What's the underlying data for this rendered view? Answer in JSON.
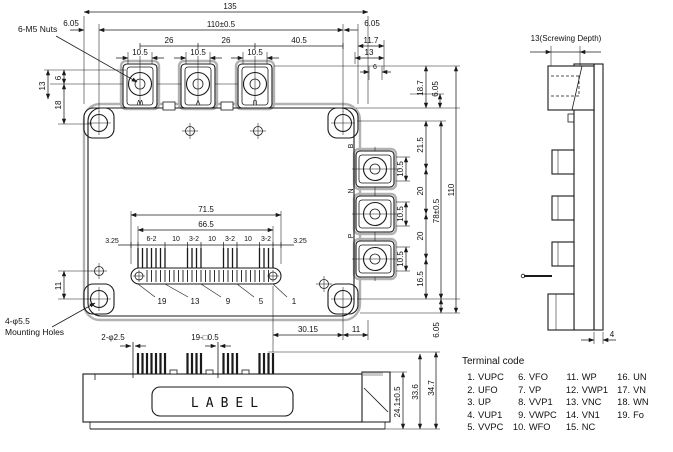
{
  "dims": {
    "overall_w": "135",
    "body_w": "110±0.5",
    "edge_l": "6.05",
    "edge_r": "6.05",
    "pitch_a": "26",
    "pitch_b": "26",
    "pitch_c": "40.5",
    "pad_a": "10.5",
    "pad_b": "10.5",
    "pad_c": "10.5",
    "r_top_a": "11.7",
    "r_top_b": "13",
    "r_top_c": "6",
    "l_a": "13",
    "l_b": "6",
    "l_c": "18",
    "l_d": "11",
    "rs_a": "18.7",
    "rs_b": "6.05",
    "rs_c": "21.5",
    "rs_d": "10.5",
    "rs_e": "20",
    "rs_f": "10.5",
    "rs_g": "20",
    "rs_h": "10.5",
    "rs_i": "16.5",
    "rs_pitch": "78±0.5",
    "rs_overall": "110",
    "rs_bottom": "6.05",
    "b_a": "30.15",
    "b_b": "11",
    "pins_outer": "71.5",
    "pins_inner": "66.5",
    "pins_edge_l": "3.25",
    "pins_edge_r": "3.25",
    "pg1": "6-2",
    "ps1": "10",
    "pg2": "3-2",
    "ps2": "10",
    "pg3": "3-2",
    "ps3": "10",
    "pg4": "3-2",
    "pn1": "19",
    "pn2": "13",
    "pn3": "9",
    "pn4": "5",
    "pn5": "1",
    "fv_pin_round": "2-φ2.5",
    "fv_pin_sq": "19-□0.5",
    "fv_a": "24.1±0.5",
    "fv_b": "33.6",
    "fv_c": "34.7",
    "sv_screw": "13(Screwing Depth)",
    "sv_base": "4"
  },
  "labels": {
    "nuts": "6-M5 Nuts",
    "mount1": "4-φ5.5",
    "mount2": "Mounting Holes",
    "label_word": "LABEL",
    "t_w": "W",
    "t_v": "V",
    "t_u": "U",
    "t_b": "B",
    "t_n": "N",
    "t_p": "P"
  },
  "terminal_code": {
    "title": "Terminal code",
    "items": [
      {
        "num": "1.",
        "label": "VUPC"
      },
      {
        "num": "2.",
        "label": "UFO"
      },
      {
        "num": "3.",
        "label": "UP"
      },
      {
        "num": "4.",
        "label": "VUP1"
      },
      {
        "num": "5.",
        "label": "VVPC"
      },
      {
        "num": "6.",
        "label": "VFO"
      },
      {
        "num": "7.",
        "label": "VP"
      },
      {
        "num": "8.",
        "label": "VVP1"
      },
      {
        "num": "9.",
        "label": "VWPC"
      },
      {
        "num": "10.",
        "label": "WFO"
      },
      {
        "num": "11.",
        "label": "WP"
      },
      {
        "num": "12.",
        "label": "VWP1"
      },
      {
        "num": "13.",
        "label": "VNC"
      },
      {
        "num": "14.",
        "label": "VN1"
      },
      {
        "num": "15.",
        "label": "NC"
      },
      {
        "num": "16.",
        "label": "UN"
      },
      {
        "num": "17.",
        "label": "VN"
      },
      {
        "num": "18.",
        "label": "WN"
      },
      {
        "num": "19.",
        "label": "Fo"
      }
    ]
  }
}
